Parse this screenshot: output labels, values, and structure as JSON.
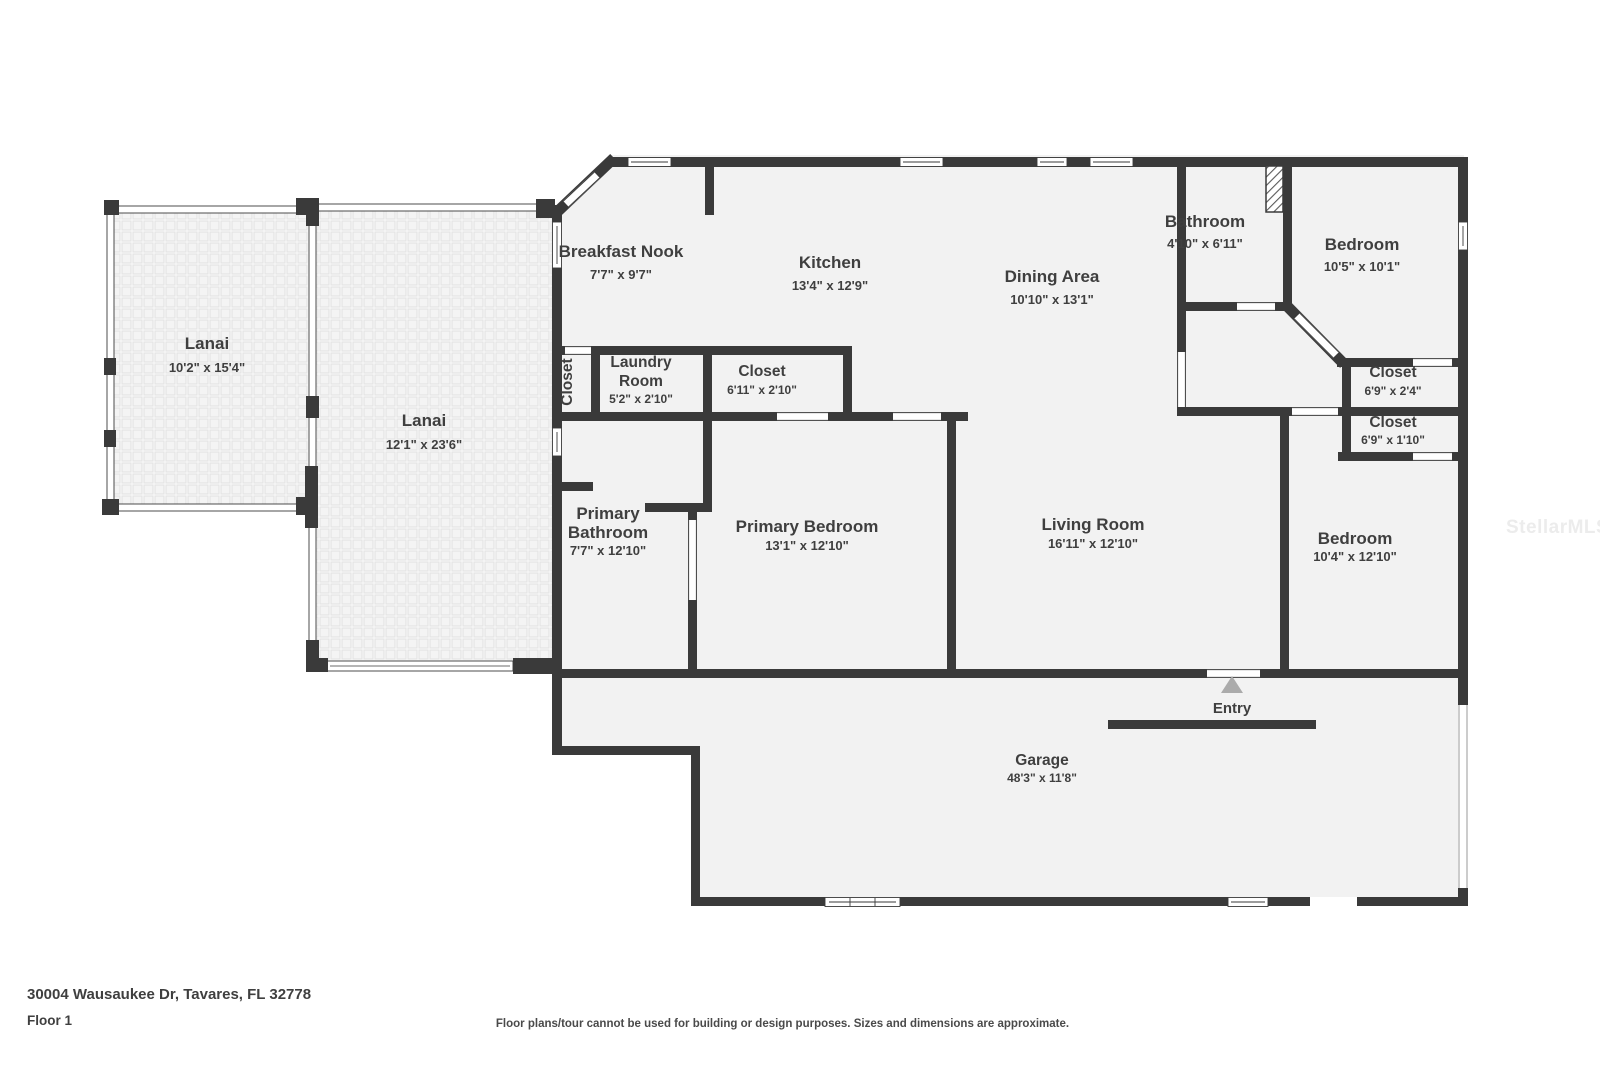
{
  "address": "30004 Wausaukee Dr, Tavares, FL 32778",
  "floor_label": "Floor 1",
  "disclaimer": "Floor plans/tour cannot be used for building or design purposes. Sizes and dimensions are approximate.",
  "watermark": "StellarMLS",
  "colors": {
    "wall": "#3a3a3a",
    "floor": "#f2f2f2",
    "text": "#3f3f3f",
    "entry_arrow": "#ababab",
    "watermark": "#ececec"
  },
  "rooms": {
    "lanai1": {
      "name": "Lanai",
      "dims": "10'2\" x 15'4\""
    },
    "lanai2": {
      "name": "Lanai",
      "dims": "12'1\" x 23'6\""
    },
    "breakfast_nook": {
      "name": "Breakfast Nook",
      "dims": "7'7\" x 9'7\""
    },
    "kitchen": {
      "name": "Kitchen",
      "dims": "13'4\" x 12'9\""
    },
    "dining": {
      "name": "Dining Area",
      "dims": "10'10\" x 13'1\""
    },
    "bathroom": {
      "name": "Bathroom",
      "dims": "4'10\" x 6'11\""
    },
    "bedroom_top": {
      "name": "Bedroom",
      "dims": "10'5\" x 10'1\""
    },
    "closet_hall": {
      "name": "Closet"
    },
    "laundry": {
      "name_line1": "Laundry",
      "name_line2": "Room",
      "dims": "5'2\" x 2'10\""
    },
    "closet_laundry": {
      "name": "Closet",
      "dims": "6'11\" x 2'10\""
    },
    "closet_bed1": {
      "name": "Closet",
      "dims": "6'9\" x 2'4\""
    },
    "closet_bed2": {
      "name": "Closet",
      "dims": "6'9\" x 1'10\""
    },
    "primary_bathroom": {
      "name_line1": "Primary",
      "name_line2": "Bathroom",
      "dims": "7'7\" x 12'10\""
    },
    "primary_bedroom": {
      "name": "Primary Bedroom",
      "dims": "13'1\" x 12'10\""
    },
    "living": {
      "name": "Living Room",
      "dims": "16'11\" x 12'10\""
    },
    "bedroom_bottom": {
      "name": "Bedroom",
      "dims": "10'4\" x 12'10\""
    },
    "entry": {
      "name": "Entry"
    },
    "garage": {
      "name": "Garage",
      "dims": "48'3\" x 11'8\""
    }
  }
}
